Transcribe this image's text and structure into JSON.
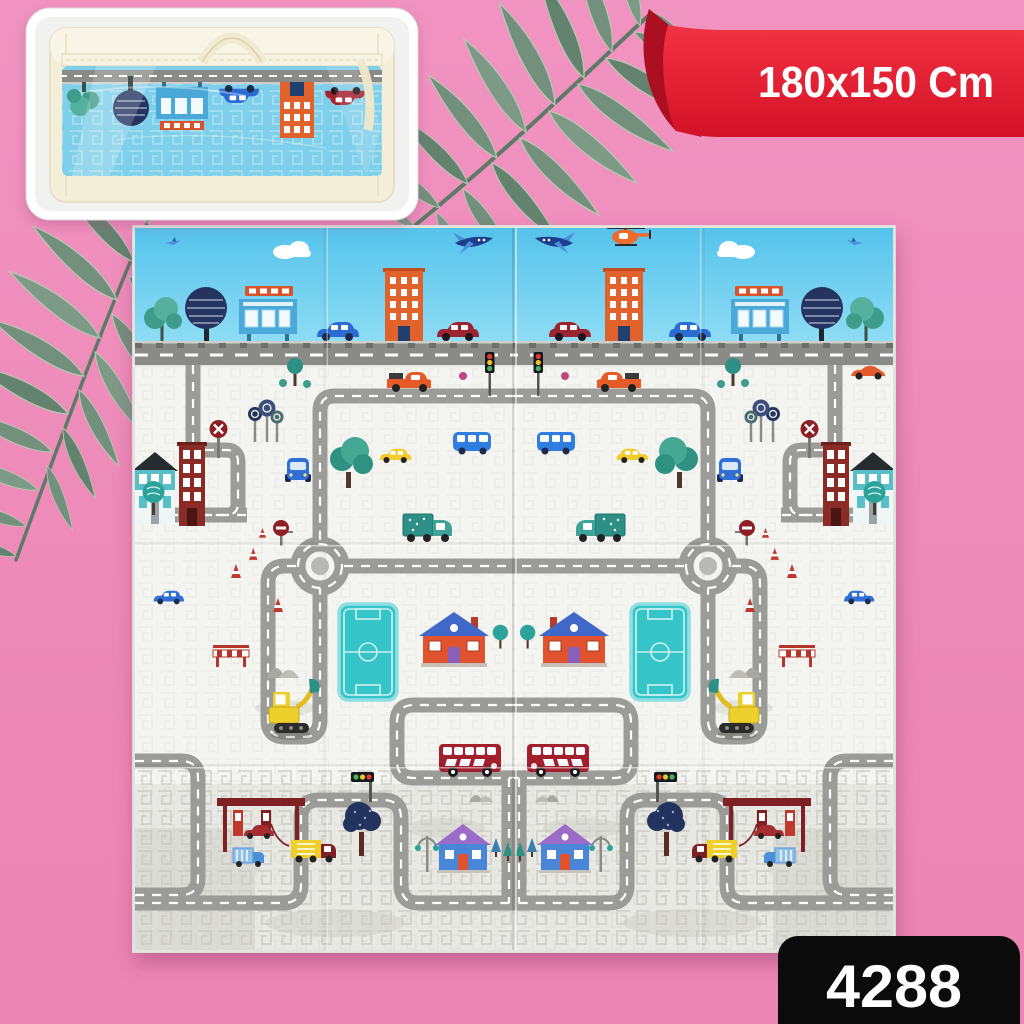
{
  "ribbon": {
    "label": "180x150 Cm"
  },
  "sku_badge": {
    "number": "4288"
  },
  "colors": {
    "background_pink": "#ef8dbb",
    "ribbon_red": "#e01c30",
    "badge_black": "#0b0b0b",
    "mat_sky_blue": "#5cc6ec",
    "mat_ground_white": "#f4f4f1",
    "road_gray": "#9b9b97",
    "palm_leaf_green": "#73907d",
    "soccer_field_teal": "#35c4c8",
    "carry_bag_cream": "#f3eed7"
  },
  "scene_elements": [
    "palm-leaf",
    "carry-bag-photo-inset",
    "size-ribbon",
    "city-road-play-mat",
    "sku-badge"
  ]
}
